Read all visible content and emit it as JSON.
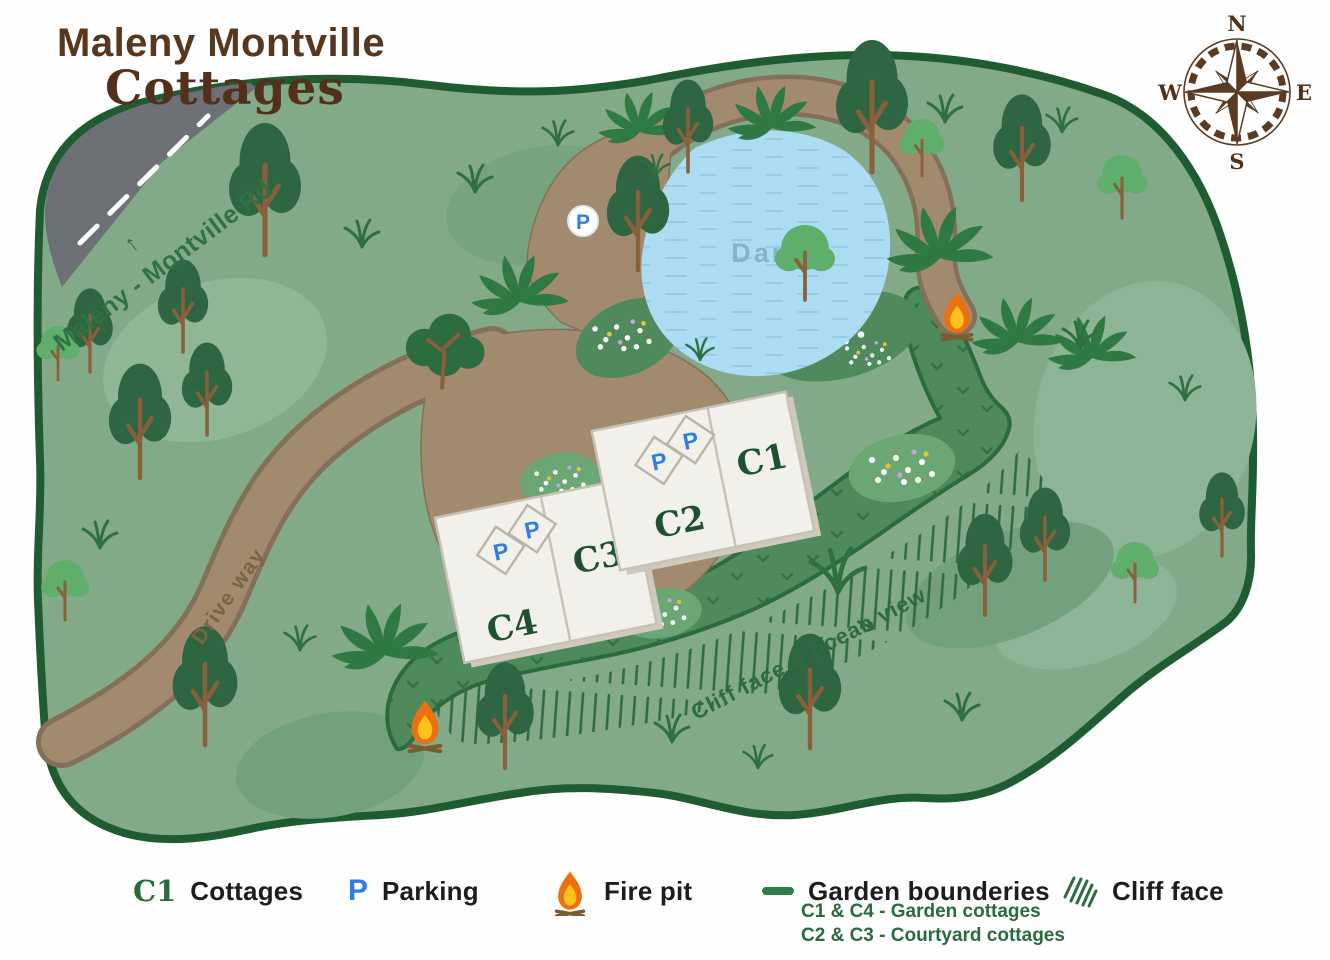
{
  "title": {
    "line1": "Maleny Montville",
    "line2": "Cottages"
  },
  "compass": {
    "north": "N",
    "east": "E",
    "south": "S",
    "west": "W"
  },
  "map_labels": {
    "road": "Maleny - Montville Rd",
    "road_arrow": "↑",
    "driveway": "Drive way",
    "dam": "Dam",
    "cliff_view": "Cliff face & ocean view",
    "cliff_arrow": "↘",
    "parking_letter": "P"
  },
  "cottages": [
    {
      "label": "C1"
    },
    {
      "label": "C2"
    },
    {
      "label": "C3"
    },
    {
      "label": "C4"
    }
  ],
  "legend": {
    "cottages_symbol": "C1",
    "cottages_label": "Cottages",
    "parking_symbol": "P",
    "parking_label": "Parking",
    "fire_pit_label": "Fire pit",
    "garden_label": "Garden bounderies",
    "garden_note1": "C1 & C4  - Garden cottages",
    "garden_note2": "C2 & C3 - Courtyard cottages",
    "cliff_label": "Cliff face"
  },
  "colors": {
    "property_green": "#82aa89",
    "border_green": "#1f5c31",
    "garden_dark_green": "#4e8a5b",
    "path_brown": "#a18a6e",
    "road_gray": "#6d7176",
    "dam_blue": "#abdcf2",
    "title_brown": "#58371f",
    "parking_blue": "#2f7ce2",
    "flame_orange": "#ec6f10",
    "label_green": "#2e6b40",
    "compass_brown": "#5b3a22"
  }
}
